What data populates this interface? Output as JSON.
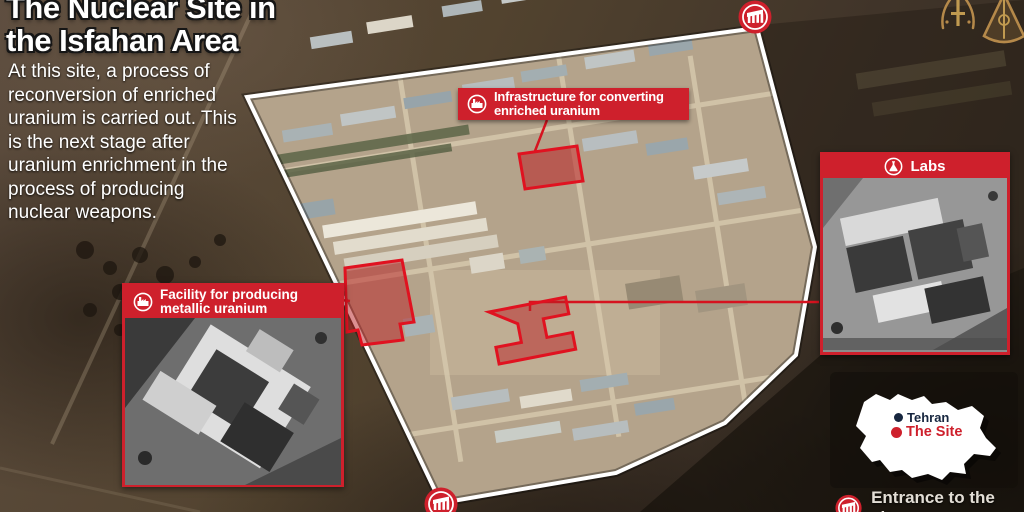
{
  "header": {
    "title_line1": "The Nuclear Site in",
    "title_line2": "the Isfahan Area",
    "description": "At this site, a process of reconversion of enriched uranium is carried out. This is the next stage after uranium enrichment in the process of producing nuclear weapons."
  },
  "callouts": {
    "infrastructure": {
      "line1": "Infrastructure for converting",
      "line2": "enriched uranium",
      "icon": "factory-icon"
    },
    "facility": {
      "line1": "Facility for producing",
      "line2": "metallic uranium",
      "icon": "factory-icon"
    },
    "labs": {
      "label": "Labs",
      "icon": "flask-icon"
    },
    "entrance": {
      "label": "Entrance to the site",
      "icon": "gate-icon"
    }
  },
  "map_inset": {
    "capital": {
      "label": "Tehran",
      "dot_color": "#17263f"
    },
    "site": {
      "label": "The Site",
      "dot_color": "#ce202c"
    }
  },
  "colors": {
    "accent_red": "#ce202c",
    "perimeter_outline": "#ffffff",
    "emblem_gold": "#b5894a",
    "title_text": "#ffffff"
  }
}
